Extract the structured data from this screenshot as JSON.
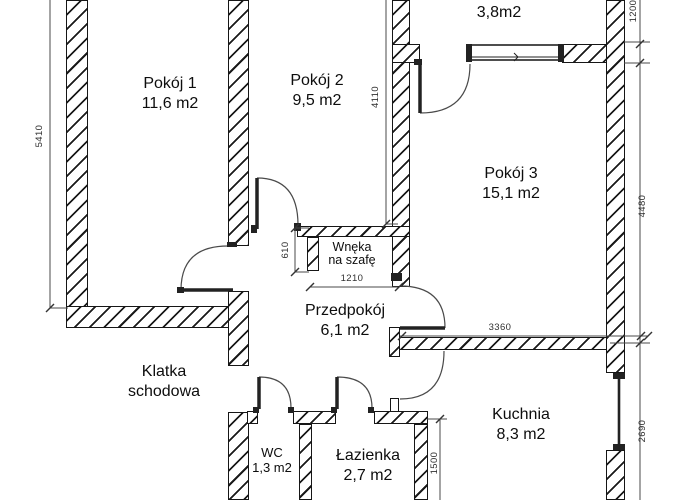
{
  "drawing": {
    "type": "floor-plan",
    "rooms": [
      {
        "id": "pokoj1",
        "line1": "Pokój 1",
        "line2": "11,6 m2"
      },
      {
        "id": "pokoj2",
        "line1": "Pokój 2",
        "line2": "9,5 m2"
      },
      {
        "id": "pokoj3",
        "line1": "Pokój 3",
        "line2": "15,1 m2"
      },
      {
        "id": "balkon",
        "line1": "Balkon",
        "line2": "3,8m2"
      },
      {
        "id": "wneka",
        "line1": "Wnęka",
        "line2": "na szafę"
      },
      {
        "id": "przedpokoj",
        "line1": "Przedpokój",
        "line2": "6,1 m2"
      },
      {
        "id": "klatka",
        "line1": "Klatka",
        "line2": "schodowa"
      },
      {
        "id": "wc",
        "line1": "WC",
        "line2": "1,3 m2"
      },
      {
        "id": "lazienka",
        "line1": "Łazienka",
        "line2": "2,7 m2"
      },
      {
        "id": "kuchnia",
        "line1": "Kuchnia",
        "line2": "8,3 m2"
      }
    ],
    "dimensions": {
      "d5410": "5410",
      "d4110": "4110",
      "d1200": "1200",
      "d4480": "4480",
      "d2690": "2690",
      "d3360": "3360",
      "d610": "610",
      "d1210": "1210",
      "d1500": "1500"
    },
    "colors": {
      "line": "#161616",
      "dim_text": "#303030",
      "background": "#ffffff"
    }
  }
}
